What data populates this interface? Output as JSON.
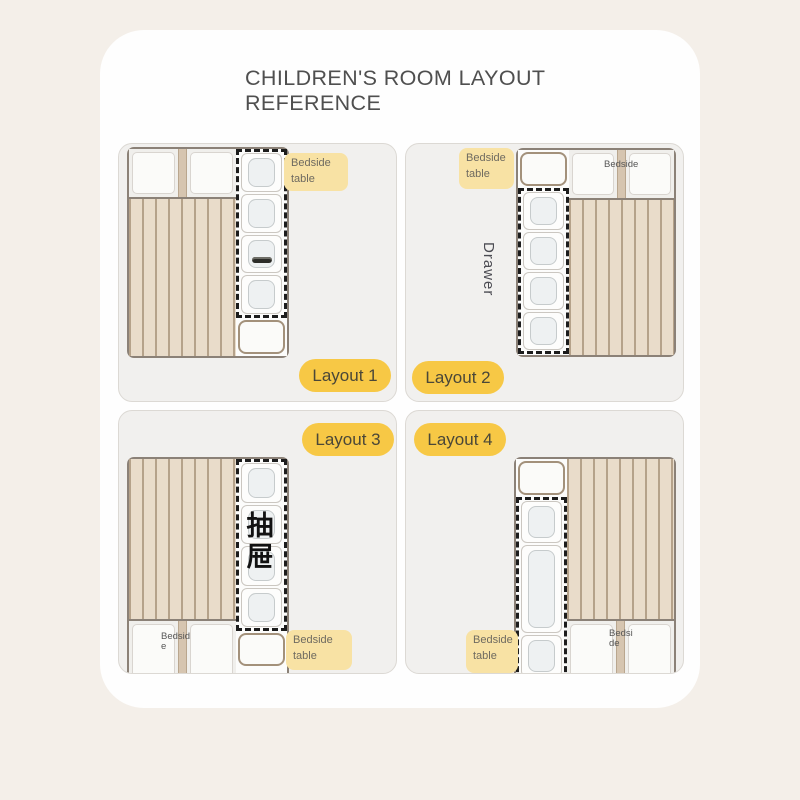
{
  "title": {
    "line1": "CHILDREN'S ROOM LAYOUT",
    "line2": "REFERENCE"
  },
  "labels": {
    "bedside_table": {
      "line1": "Bedside",
      "line2": "table"
    },
    "bedside": "Bedside",
    "drawer_en": "Drawer",
    "drawer_zh": "抽屉"
  },
  "layouts": [
    {
      "pill": "Layout 1"
    },
    {
      "pill": "Layout 2"
    },
    {
      "pill": "Layout 3"
    },
    {
      "pill": "Layout 4"
    }
  ],
  "colors": {
    "page_background": "#f4efe9",
    "card": "#fefefe",
    "panel": "#f1f0ee",
    "pill_accent": "#f7c845",
    "tag_highlight": "#f8e2a4",
    "bed_frame": "#8b8177",
    "mattress": "#e9dcca",
    "mattress_stripe": "#b5a28a",
    "bedside_border": "#a3917b",
    "dash_outline": "#1c1c1c",
    "title_text": "#4f4f4f"
  }
}
